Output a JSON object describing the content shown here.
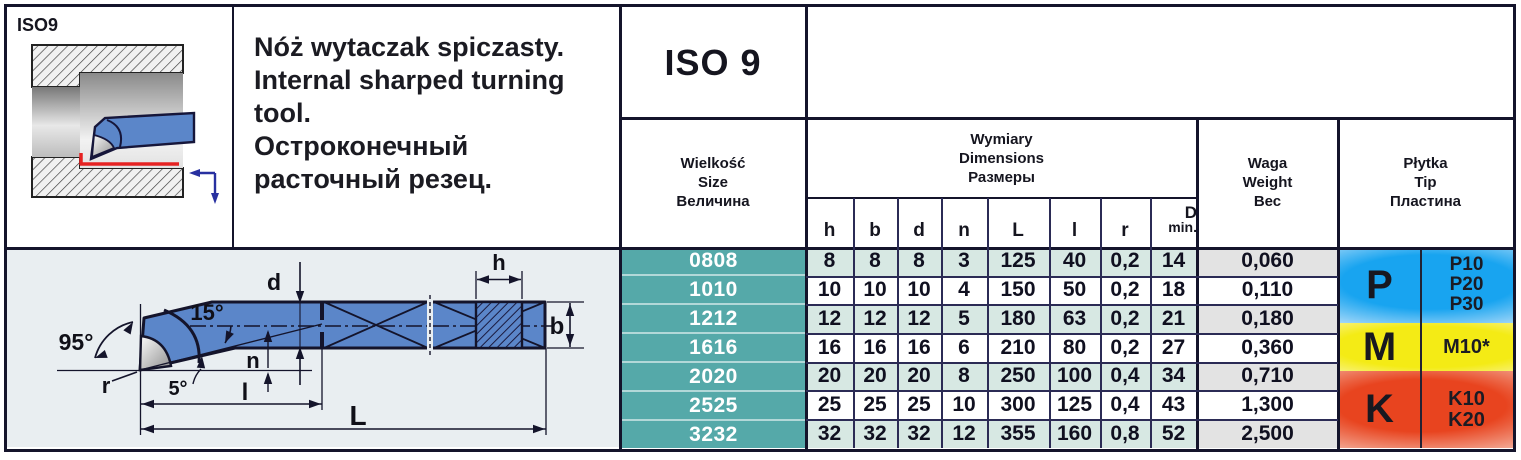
{
  "header": {
    "thumb_label": "ISO9",
    "iso_code": "ISO 9",
    "description_lines": [
      "Nóż wytaczak spiczasty.",
      "Internal sharped turning tool.",
      "Остроконечный расточный резец."
    ]
  },
  "table": {
    "size_header": [
      "Wielkość",
      "Size",
      "Величина"
    ],
    "dims_header": [
      "Wymiary",
      "Dimensions",
      "Размеры"
    ],
    "weight_header": [
      "Waga",
      "Weight",
      "Вес"
    ],
    "tip_header": [
      "Płytka",
      "Tip",
      "Пластина"
    ],
    "dim_columns": [
      "h",
      "b",
      "d",
      "n",
      "L",
      "l",
      "r"
    ],
    "dmin_col": {
      "top": "D",
      "bottom": "min."
    },
    "rows": [
      [
        "0808",
        "8",
        "8",
        "8",
        "3",
        "125",
        "40",
        "0,2",
        "14",
        "0,060"
      ],
      [
        "1010",
        "10",
        "10",
        "10",
        "4",
        "150",
        "50",
        "0,2",
        "18",
        "0,110"
      ],
      [
        "1212",
        "12",
        "12",
        "12",
        "5",
        "180",
        "63",
        "0,2",
        "21",
        "0,180"
      ],
      [
        "1616",
        "16",
        "16",
        "16",
        "6",
        "210",
        "80",
        "0,2",
        "27",
        "0,360"
      ],
      [
        "2020",
        "20",
        "20",
        "20",
        "8",
        "250",
        "100",
        "0,4",
        "34",
        "0,710"
      ],
      [
        "2525",
        "25",
        "25",
        "25",
        "10",
        "300",
        "125",
        "0,4",
        "43",
        "1,300"
      ],
      [
        "3232",
        "32",
        "32",
        "32",
        "12",
        "355",
        "160",
        "0,8",
        "52",
        "2,500"
      ]
    ]
  },
  "tip_grades": {
    "p": {
      "letter": "P",
      "grades": [
        "P10",
        "P20",
        "P30"
      ],
      "color": "#18a4f0"
    },
    "m": {
      "letter": "M",
      "grades": [
        "M10*"
      ],
      "color": "#f4eb15"
    },
    "k": {
      "letter": "K",
      "grades": [
        "K10",
        "K20"
      ],
      "color": "#e8441f"
    }
  },
  "drawing": {
    "labels": {
      "main_angle": "95°",
      "neck_angle": "15°",
      "clearance_angle": "5°",
      "radius": "r",
      "n": "n",
      "d": "d",
      "l": "l",
      "L": "L",
      "h": "h",
      "b": "b"
    }
  },
  "colors": {
    "size_column_teal": "#55a9a9",
    "row_stripe_teal": "#d7e8e3",
    "row_stripe_gray": "#e3e3e3",
    "tool_blue": "#5b86c9",
    "cut_line_red": "#e62222",
    "feed_arrow_navy": "#2830a0",
    "grid_dark": "#14142b"
  }
}
